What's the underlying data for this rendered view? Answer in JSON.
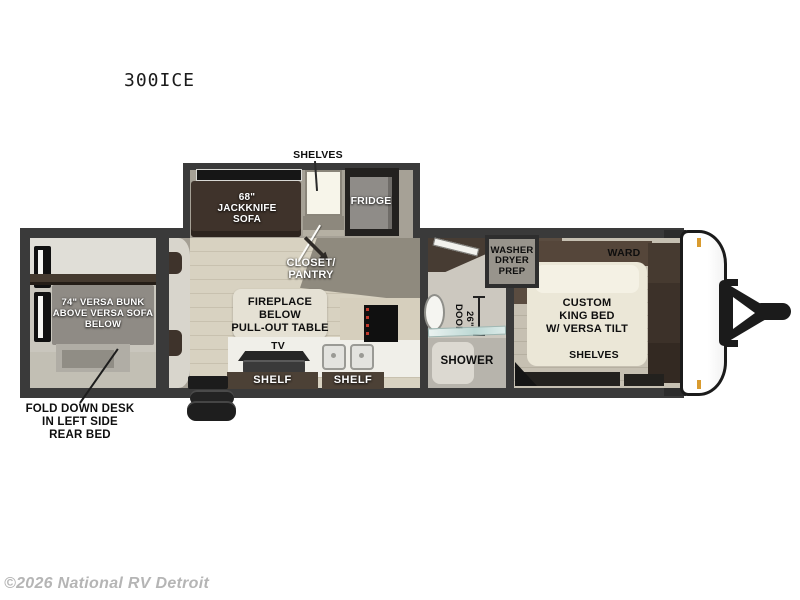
{
  "title": "300ICE",
  "watermark": "©2026 National RV Detroit",
  "labels": {
    "shelves_top": "SHELVES",
    "sofa": "68\"\nJACKKNIFE\nSOFA",
    "fridge": "FRIDGE",
    "closet_pantry": "CLOSET/\nPANTRY",
    "bunk": "74\" VERSA BUNK\nABOVE VERSA SOFA\nBELOW",
    "fold_down_desk": "FOLD DOWN DESK\nIN LEFT SIDE\nREAR BED",
    "fireplace": "FIREPLACE\nBELOW\nPULL-OUT TABLE",
    "tv": "TV",
    "shelf_left": "SHELF",
    "shelf_right": "SHELF",
    "washer_prep": "WASHER\nDRYER\nPREP",
    "door_26": "26\"\nDOOR",
    "shower": "SHOWER",
    "ward": "WARD",
    "shelves_bed_top": "SHELVES",
    "king_bed": "CUSTOM\nKING BED\nW/ VERSA TILT",
    "shelves_bed_bottom": "SHELVES"
  },
  "colors": {
    "wall": "#3a3a3a",
    "wood_dark": "#3f332b",
    "wood_bar": "#4c4136",
    "floor_beige": "#d8d2c1",
    "floor_gray": "#a49f94",
    "bed_cream": "#ebe7d7",
    "marker_orange": "#d99b2f"
  }
}
